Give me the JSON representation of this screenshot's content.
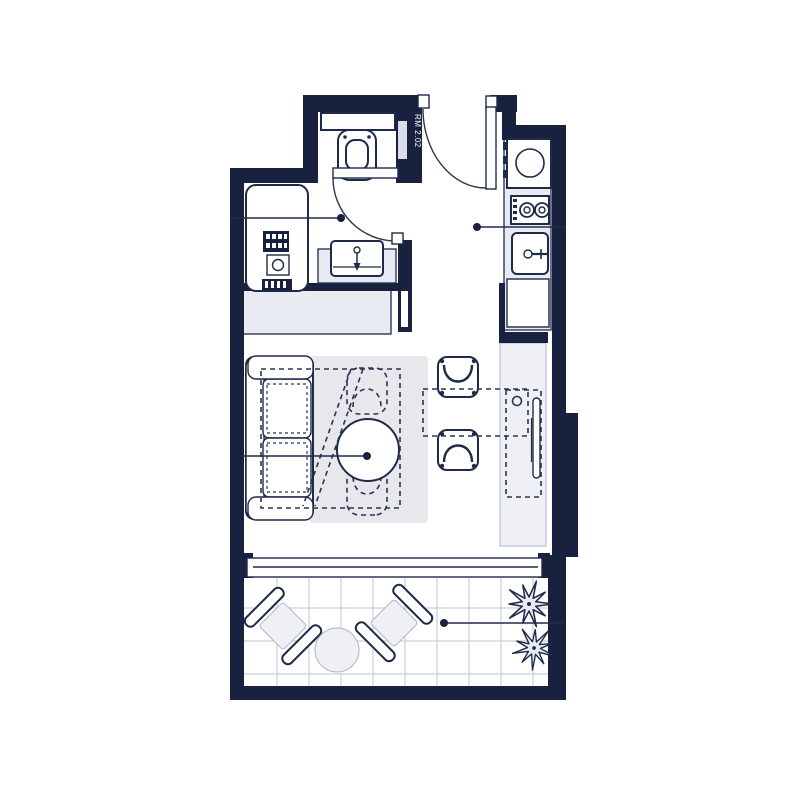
{
  "room_label": "RM 2.02",
  "colors": {
    "wall": "#18223f",
    "fixture_outline": "#1e2a4a",
    "light_fill": "#e9ebf2",
    "softer_fill": "#eef0f6",
    "rug": "#e7e7ec",
    "tile_grid": "#c9cfdb",
    "background": "#ffffff",
    "label_text": "#ffffff"
  },
  "rooms": [
    {
      "name": "bathroom",
      "fixtures": [
        "shower-stall",
        "floor-drain",
        "wall-hung-toilet",
        "vanity-sink",
        "swing-door"
      ]
    },
    {
      "name": "entry",
      "fixtures": [
        "entry-swing-door",
        "duct-shaft"
      ]
    },
    {
      "name": "kitchen",
      "fixtures": [
        "washer-appliance",
        "two-burner-cooktop",
        "kitchen-sink",
        "base-cabinet",
        "tall-counter",
        "tv-panel",
        "overhead-cabinet-dashed"
      ]
    },
    {
      "name": "living-area",
      "fixtures": [
        "sofa",
        "rug",
        "fold-out-bed-dashed",
        "round-table",
        "dining-chair-top",
        "dining-chair-bottom",
        "dining-table-dashed",
        "wardrobe"
      ]
    },
    {
      "name": "balcony",
      "fixtures": [
        "tile-floor",
        "sliding-window",
        "outdoor-chair-left",
        "outdoor-chair-right",
        "outdoor-round-table",
        "plant-top",
        "plant-bottom"
      ]
    }
  ],
  "annotations": {
    "leader_line_count": 4
  }
}
